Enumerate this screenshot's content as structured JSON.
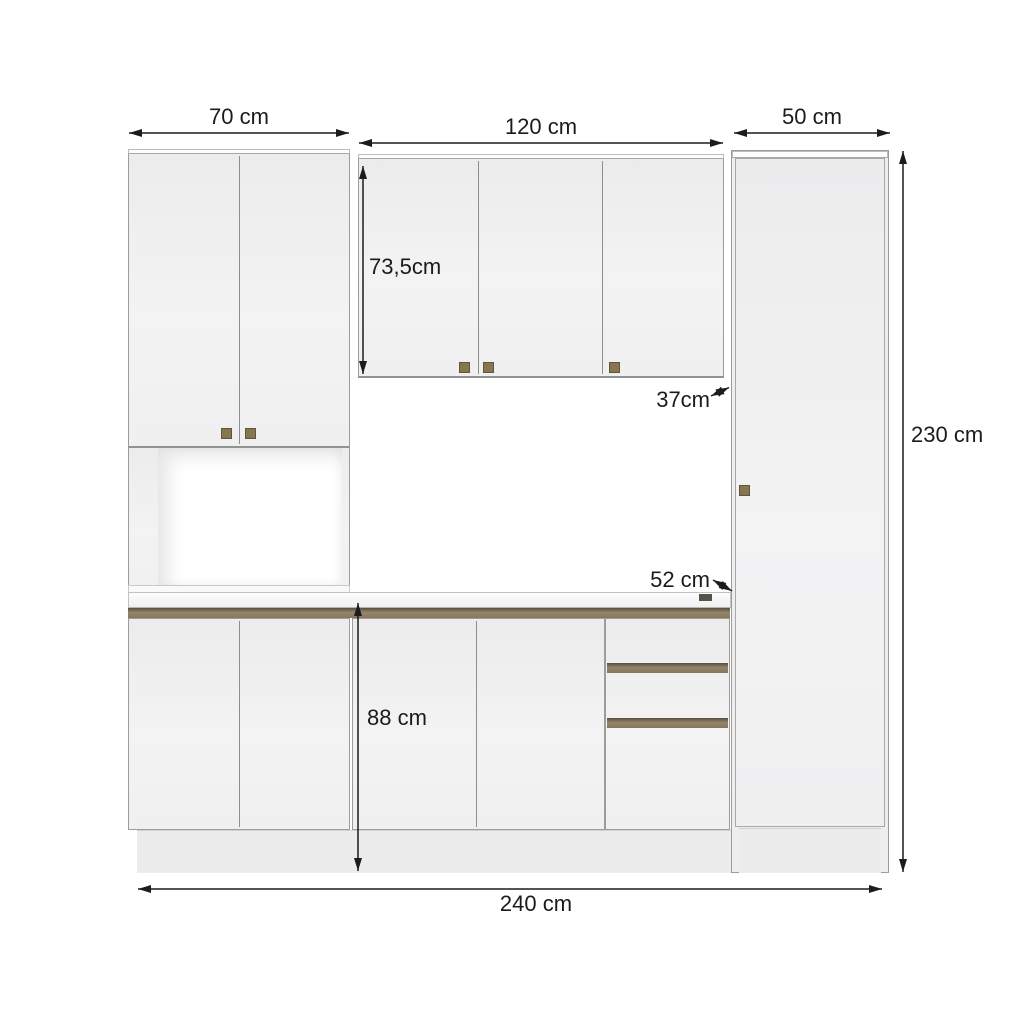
{
  "labels": {
    "width_left": "70 cm",
    "width_middle": "120 cm",
    "width_right": "50 cm",
    "upper_height": "73,5cm",
    "upper_depth": "37cm",
    "total_height": "230 cm",
    "counter_depth": "52 cm",
    "base_height": "88 cm",
    "total_width": "240 cm"
  },
  "colors": {
    "background": "#ffffff",
    "cabinet_face": "#f2f2f3",
    "cabinet_outline": "#9c9c9d",
    "handle_rail": "#8d7e62",
    "handle_knob": "#87774e",
    "plinth": "#ececed",
    "dimension_line": "#1c1c1c"
  }
}
